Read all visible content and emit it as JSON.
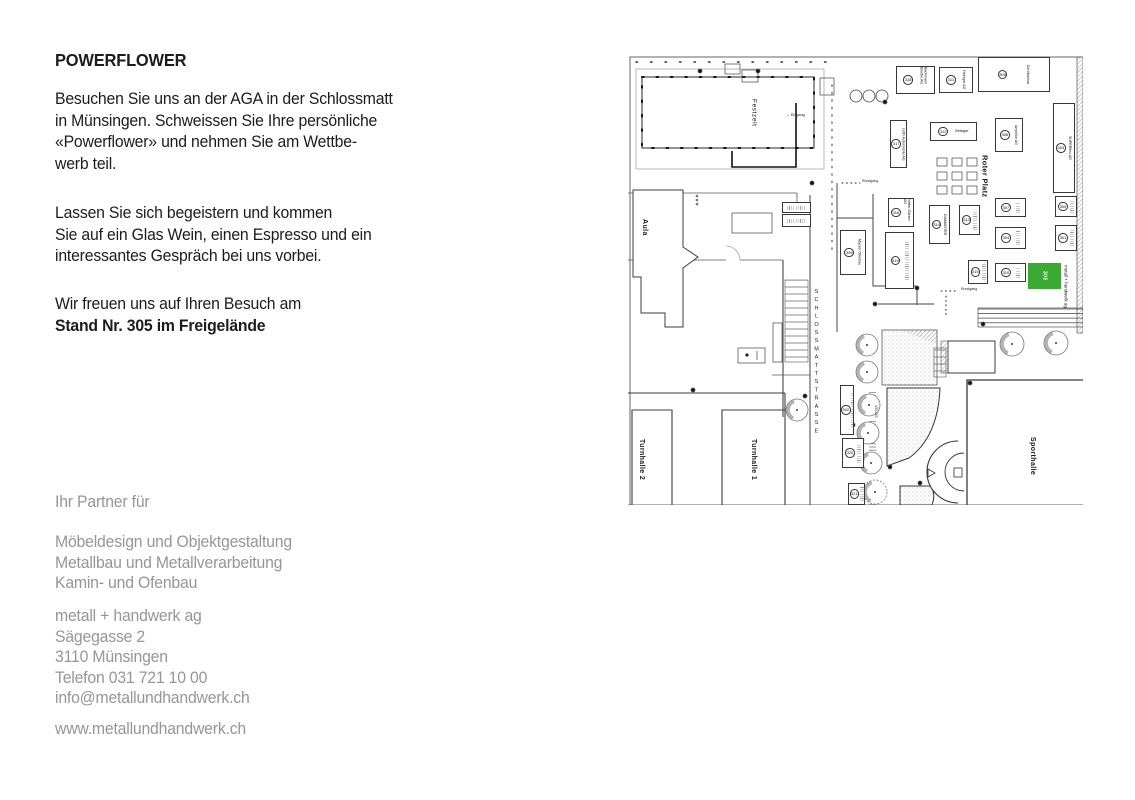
{
  "left": {
    "title": "POWERFLOWER",
    "para1": [
      "Besuchen Sie uns an der AGA in der Schlossmatt",
      "in Münsingen. Schweissen Sie Ihre persönliche",
      "«Powerflower» und nehmen Sie am Wettbe-",
      "werb teil."
    ],
    "para2": [
      "Lassen Sie sich begeistern und kommen",
      "Sie auf ein Glas Wein, einen Espresso und ein",
      "interessantes Gespräch bei uns vorbei."
    ],
    "para3_line1": "Wir freuen uns auf Ihren Besuch am",
    "para3_line2": "Stand Nr. 305 im Freigelände",
    "partner_intro": "Ihr Partner für",
    "services": [
      "Möbeldesign und Objektgestaltung",
      "Metallbau und Metallverarbeitung",
      "Kamin- und Ofenbau"
    ],
    "address": [
      "metall + handwerk ag",
      "Sägegasse 2",
      "3110 Münsingen",
      "Telefon 031 721 10 00",
      "info@metallundhandwerk.ch"
    ],
    "website": "www.metallundhandwerk.ch",
    "text_color": "#1c1c1c",
    "muted_color": "#969696"
  },
  "map": {
    "street": "SCHLOSSMATTSTRASSE",
    "buildings": {
      "festzelt": "Festzelt",
      "aula": "Aula",
      "turnhalle2": "Turnhalle 2",
      "turnhalle1": "Turnhalle 1",
      "sporthalle": "Sporthalle",
      "roter_platz": "Roter Platz"
    },
    "labels": {
      "eingang": "← Eingang",
      "rundgang": "Rundgang",
      "velos": "VELOS"
    },
    "highlight": {
      "number": "305",
      "company": "metall + handwerk ag",
      "color": "#3aaa35"
    },
    "booths": [
      {
        "n": "318",
        "l": "Bachmann Elektro AG",
        "x": 268,
        "y": 11,
        "w": 39,
        "h": 28,
        "dir": "v"
      },
      {
        "n": "311",
        "l": "Heiniger AG",
        "x": 311,
        "y": 12,
        "w": 34,
        "h": 26,
        "dir": "v"
      },
      {
        "n": "308",
        "l": "Die Mobiliar",
        "x": 350,
        "y": 2,
        "w": 72,
        "h": 35,
        "dir": "v"
      },
      {
        "n": "317",
        "l": "Lüthi Automobile AG",
        "x": 262,
        "y": 65,
        "w": 17,
        "h": 48,
        "dir": "v"
      },
      {
        "n": "312",
        "l": "Betsiger",
        "x": 302,
        "y": 67,
        "w": 47,
        "h": 19,
        "dir": "h"
      },
      {
        "n": "306",
        "l": "Amplifon AG",
        "x": 367,
        "y": 63,
        "w": 28,
        "h": 34,
        "dir": "v"
      },
      {
        "n": "303",
        "l": "SUPERflex AG",
        "x": 425,
        "y": 48,
        "w": 22,
        "h": 90,
        "dir": "v"
      },
      {
        "n": "316",
        "l": "Vetter-Garten AG",
        "x": 260,
        "y": 143,
        "w": 26,
        "h": 29,
        "dir": "v"
      },
      {
        "n": "314",
        "l": "DIAMANTER",
        "x": 301,
        "y": 150,
        "w": 21,
        "h": 39,
        "dir": "v"
      },
      {
        "n": "313",
        "l": "",
        "x": 331,
        "y": 150,
        "w": 21,
        "h": 30,
        "dir": "v"
      },
      {
        "n": "309",
        "l": "Maurer Ofenbau",
        "x": 212,
        "y": 175,
        "w": 26,
        "h": 45,
        "dir": "v"
      },
      {
        "n": "319",
        "l": "",
        "x": 257,
        "y": 177,
        "w": 29,
        "h": 57,
        "dir": "v"
      },
      {
        "n": "307",
        "l": "",
        "x": 367,
        "y": 143,
        "w": 31,
        "h": 19,
        "dir": "v"
      },
      {
        "n": "304",
        "l": "",
        "x": 367,
        "y": 172,
        "w": 31,
        "h": 22,
        "dir": "v"
      },
      {
        "n": "300",
        "l": "",
        "x": 427,
        "y": 141,
        "w": 22,
        "h": 21,
        "dir": "v"
      },
      {
        "n": "301",
        "l": "",
        "x": 427,
        "y": 170,
        "w": 22,
        "h": 26,
        "dir": "v"
      },
      {
        "n": "315",
        "l": "",
        "x": 340,
        "y": 205,
        "w": 20,
        "h": 24,
        "dir": "v"
      },
      {
        "n": "310",
        "l": "",
        "x": 367,
        "y": 208,
        "w": 31,
        "h": 19,
        "dir": "v"
      },
      {
        "n": "302",
        "l": "",
        "x": 212,
        "y": 330,
        "w": 14,
        "h": 50,
        "dir": "v"
      },
      {
        "n": "320",
        "l": "",
        "x": 214,
        "y": 383,
        "w": 22,
        "h": 30,
        "dir": "v"
      },
      {
        "n": "321",
        "l": "",
        "x": 220,
        "y": 428,
        "w": 17,
        "h": 22,
        "dir": "v"
      },
      {
        "n": "",
        "l": "",
        "x": 154,
        "y": 147,
        "w": 29,
        "h": 11,
        "dir": "h"
      },
      {
        "n": "",
        "l": "",
        "x": 154,
        "y": 159,
        "w": 29,
        "h": 13,
        "dir": "h"
      }
    ]
  }
}
